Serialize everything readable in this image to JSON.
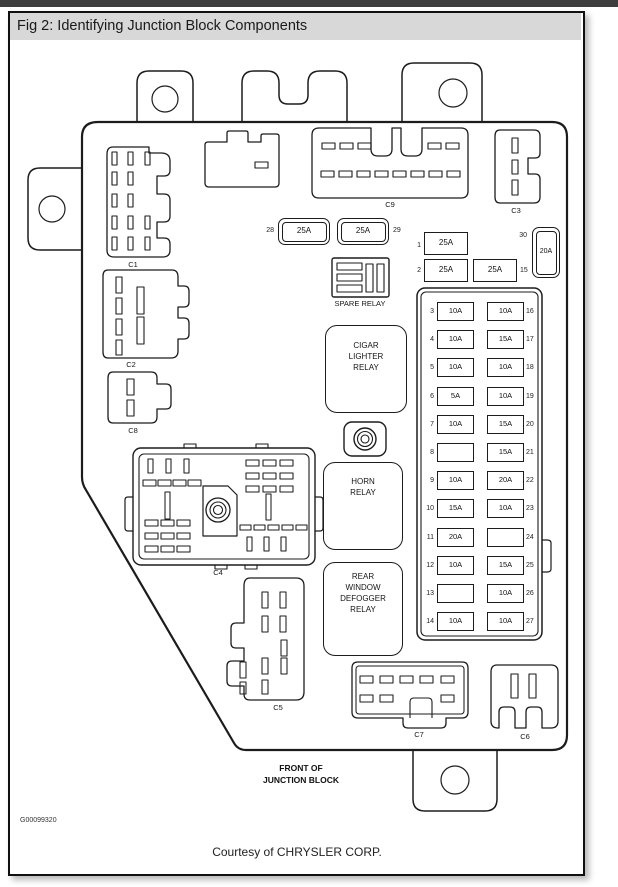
{
  "window": {
    "title": "Fig 2: Identifying Junction Block Components"
  },
  "footer": {
    "figure_code": "G00099320",
    "courtesy": "Courtesy of CHRYSLER CORP."
  },
  "diagram": {
    "front_label": [
      "FRONT OF",
      "JUNCTION BLOCK"
    ],
    "connectors": {
      "c1": "C1",
      "c2": "C2",
      "c3": "C3",
      "c4": "C4",
      "c5": "C5",
      "c6": "C6",
      "c7": "C7",
      "c8": "C8",
      "c9": "C9"
    },
    "relays": {
      "spare": [
        "SPARE",
        "RELAY"
      ],
      "cigar": [
        "CIGAR",
        "LIGHTER",
        "RELAY"
      ],
      "horn": [
        "HORN",
        "RELAY"
      ],
      "defogger": [
        "REAR",
        "WINDOW",
        "DEFOGGER",
        "RELAY"
      ]
    },
    "standalone_fuses": [
      {
        "id": "28",
        "amps": "25A"
      },
      {
        "id": "29",
        "amps": "25A"
      },
      {
        "id": "1",
        "amps": "25A"
      },
      {
        "id": "30",
        "amps": "20A"
      },
      {
        "id": "2",
        "amps": "25A"
      },
      {
        "id": "15",
        "amps": "25A"
      }
    ],
    "fuse_panel_rows": [
      {
        "left_no": "3",
        "left": "10A",
        "right": "10A",
        "right_no": "16"
      },
      {
        "left_no": "4",
        "left": "10A",
        "right": "15A",
        "right_no": "17"
      },
      {
        "left_no": "5",
        "left": "10A",
        "right": "10A",
        "right_no": "18"
      },
      {
        "left_no": "6",
        "left": "5A",
        "right": "10A",
        "right_no": "19"
      },
      {
        "left_no": "7",
        "left": "10A",
        "right": "15A",
        "right_no": "20"
      },
      {
        "left_no": "8",
        "left": "",
        "right": "15A",
        "right_no": "21"
      },
      {
        "left_no": "9",
        "left": "10A",
        "right": "20A",
        "right_no": "22"
      },
      {
        "left_no": "10",
        "left": "15A",
        "right": "10A",
        "right_no": "23"
      },
      {
        "left_no": "11",
        "left": "20A",
        "right": "",
        "right_no": "24"
      },
      {
        "left_no": "12",
        "left": "10A",
        "right": "15A",
        "right_no": "25"
      },
      {
        "left_no": "13",
        "left": "",
        "right": "10A",
        "right_no": "26"
      },
      {
        "left_no": "14",
        "left": "10A",
        "right": "10A",
        "right_no": "27"
      }
    ]
  }
}
